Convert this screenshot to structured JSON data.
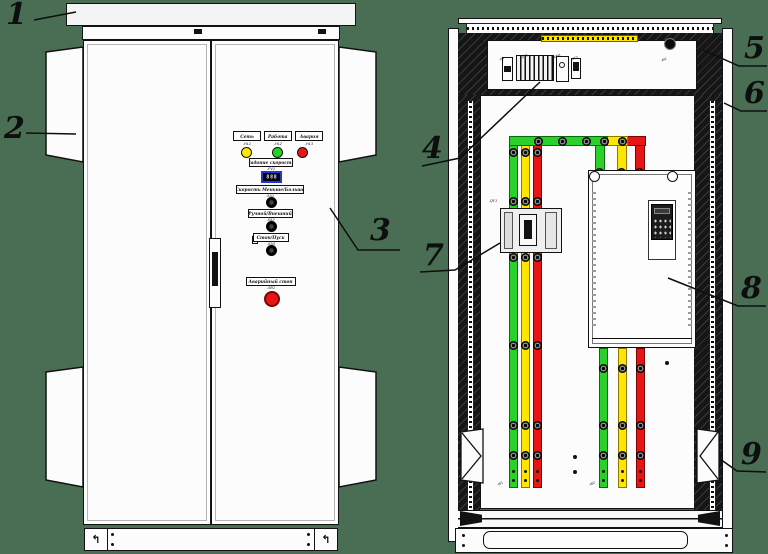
{
  "callouts": [
    "1",
    "2",
    "3",
    "4",
    "5",
    "6",
    "7",
    "8",
    "9"
  ],
  "front_panel": {
    "indicators": [
      {
        "label": "Сеть",
        "tag": "-HL1",
        "color": "#ffe600"
      },
      {
        "label": "Работа",
        "tag": "-HL2",
        "color": "#22d422"
      },
      {
        "label": "Авария",
        "tag": "-HL3",
        "color": "#e81515"
      }
    ],
    "speed_setpoint": {
      "label": "Задание скорости",
      "tag": "-PV1",
      "display_value": "888"
    },
    "controls": [
      {
        "label": "Скорость Меньше/Больше",
        "tag": "-SA1"
      },
      {
        "label": "Ручной/Внешний",
        "tag": "-SA2"
      },
      {
        "label": "Стоп/Пуск",
        "tag": "-SA3"
      }
    ],
    "emergency_stop": {
      "label": "Аварийный стоп",
      "tag": "-SB1"
    }
  },
  "internal_view": {
    "component_tags": {
      "controller": "-A1",
      "terminal_block": "-XT1",
      "relay": "-KM1",
      "aux_block": "-XT2",
      "fan": "-M1",
      "circuit_breaker": "-QF1",
      "left_busbar": "-W1",
      "right_busbar": "-W2"
    },
    "busbar_colors": {
      "phase_a": "#2bd12b",
      "phase_b": "#ffe600",
      "phase_c": "#e81515"
    }
  },
  "canvas": {
    "background": "#4a6e54",
    "line_color": "#111111",
    "panel_white": "#fcfcfc"
  }
}
